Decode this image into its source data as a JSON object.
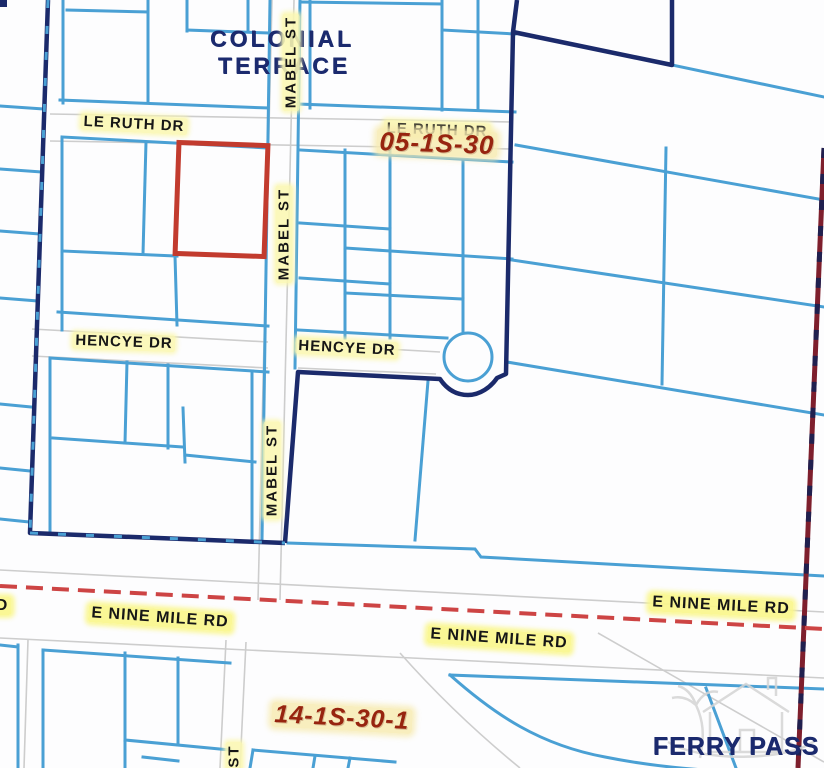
{
  "map": {
    "region_labels": {
      "colonial_line1": "COLONIAL",
      "colonial_line2": "TERRACE",
      "ferry_pass": "FERRY PASS"
    },
    "section_labels": {
      "north": "05-1S-30",
      "south": "14-1S-30-1"
    },
    "street_labels": {
      "le_ruth": "LE RUTH DR",
      "le_ruth_hidden": "LE RUTH DR",
      "mabel_top": "MABEL ST",
      "mabel_middle": "MABEL ST",
      "mabel_lower": "MABEL ST",
      "mabel_cut": "ST",
      "hencye_west": "HENCYE DR",
      "hencye_east": "HENCYE DR",
      "nine_mile_left": "E NINE MILE RD",
      "nine_mile_middle": "E NINE MILE RD",
      "nine_mile_right": "E NINE MILE RD",
      "nine_mile_edge_cut": "D"
    },
    "colors": {
      "parcel_line": "#4aa0d4",
      "boundary_line": "#1b2a6b",
      "highlight_parcel": "#c23b2e",
      "road_centerline": "#cd4444",
      "section_line": "#7e1f2d",
      "street_edge": "#cdcdcd",
      "street_label_text": "#161616",
      "street_label_halo": "#fbf7b2",
      "road_label_halo": "#faf68c",
      "section_label_text": "#97240f",
      "region_label_text": "#1b2a6e"
    }
  }
}
